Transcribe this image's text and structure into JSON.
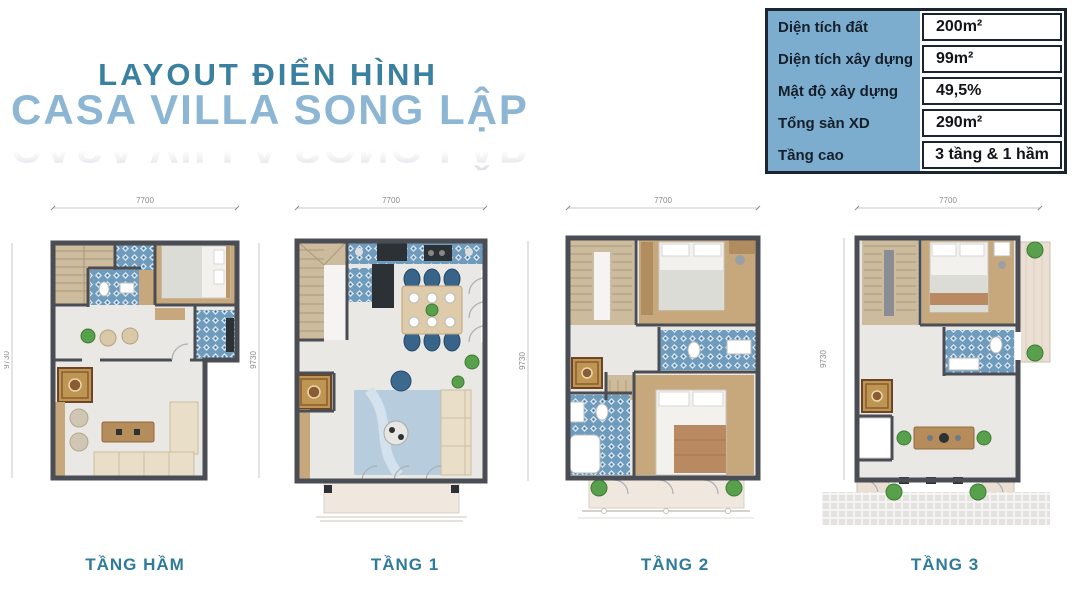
{
  "header": {
    "title": "LAYOUT ĐIỂN HÌNH",
    "subtitle": "CASA VILLA SONG LẬP"
  },
  "specs": {
    "rows": [
      {
        "label": "Diện tích đất",
        "value": "200m²"
      },
      {
        "label": "Diện tích xây dựng",
        "value": "99m²"
      },
      {
        "label": "Mật độ xây dựng",
        "value": "49,5%"
      },
      {
        "label": "Tổng sàn XD",
        "value": "290m²"
      },
      {
        "label": "Tầng cao",
        "value": "3 tầng & 1 hầm"
      }
    ]
  },
  "plans": [
    {
      "name": "TẦNG HẦM",
      "width_label": "7700",
      "height_label": "9730"
    },
    {
      "name": "TẦNG 1",
      "width_label": "7700",
      "height_label": "9730"
    },
    {
      "name": "TẦNG 2",
      "width_label": "7700",
      "height_label": "9730"
    },
    {
      "name": "TẦNG 3",
      "width_label": "7700",
      "height_label": "9730"
    }
  ],
  "colors": {
    "title_teal": "#3a80a0",
    "subtitle_blue": "#8cb6d4",
    "caption_teal": "#2e7b9c",
    "table_header_blue": "#7dadce",
    "table_border_navy": "#1b2531",
    "wall_gray": "#4a4e54",
    "tile_blue": "#6f9cbd"
  }
}
